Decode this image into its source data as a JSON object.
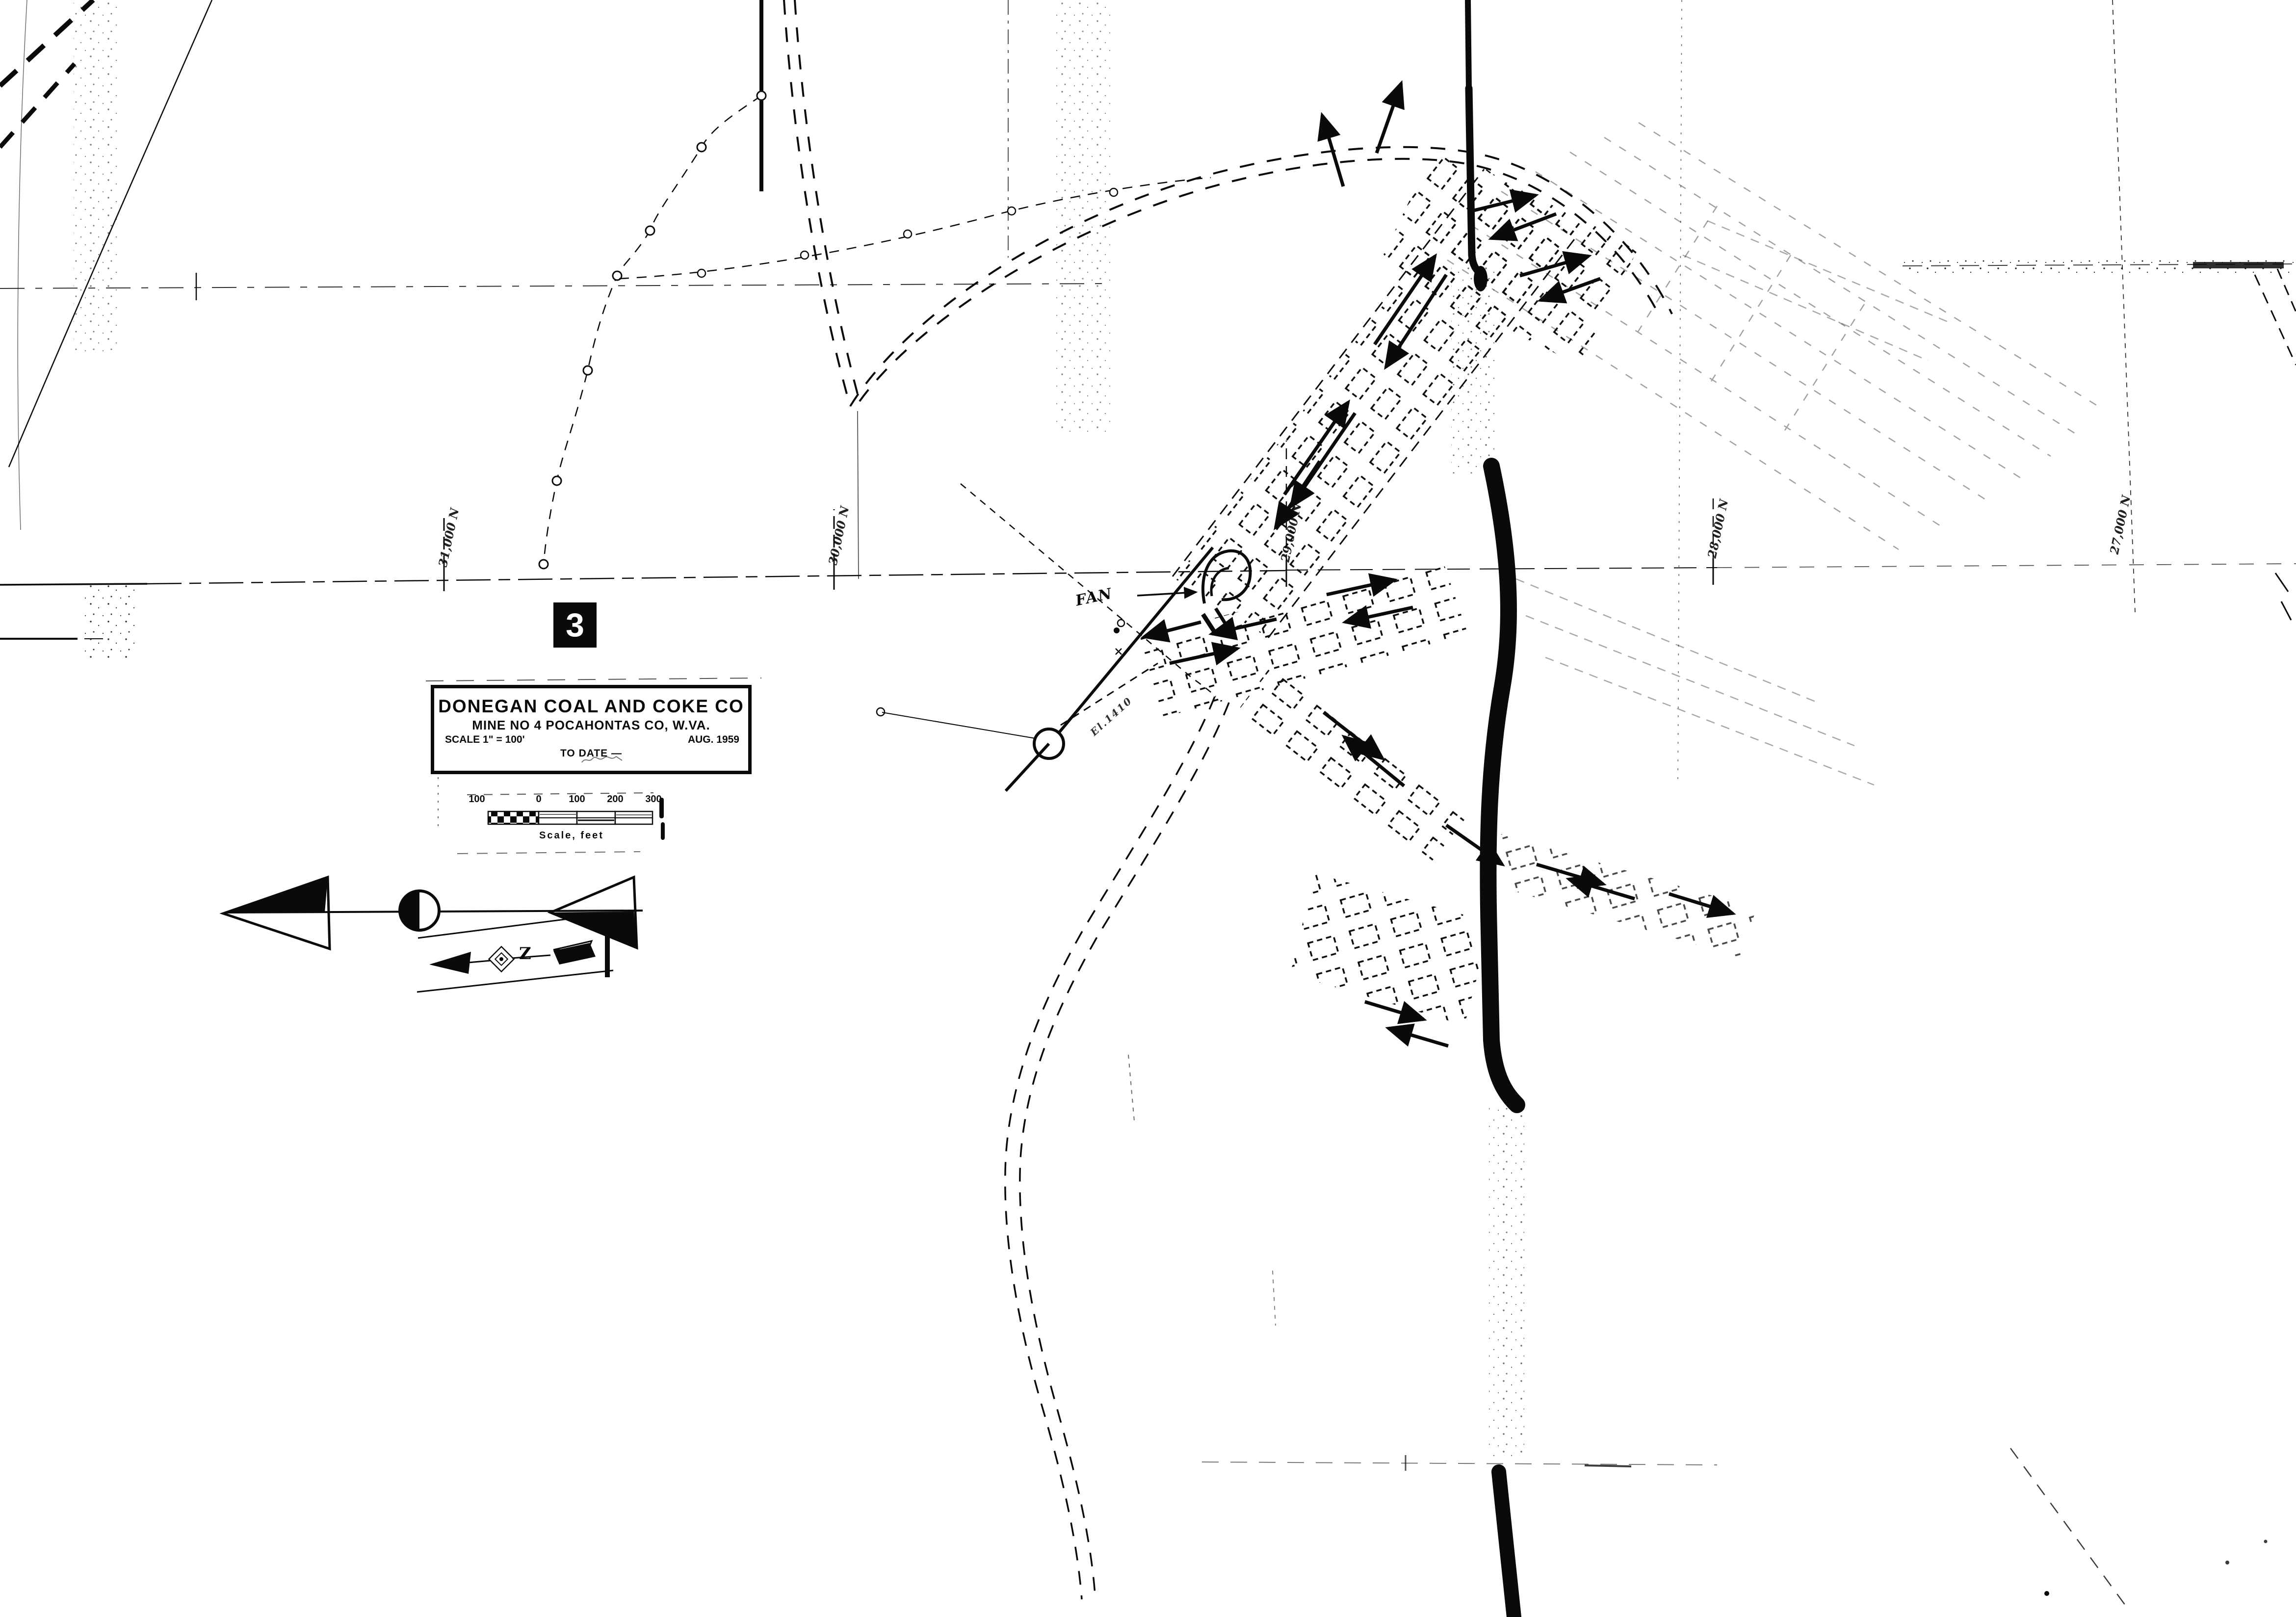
{
  "page": {
    "background": "#ffffff",
    "ink": "#0a0a0a"
  },
  "badge": {
    "number": "3"
  },
  "title_block": {
    "company": "DONEGAN COAL AND COKE CO",
    "mine_line": "MINE NO 4   POCAHONTAS CO,  W.VA.",
    "scale_label": "SCALE  1\" = 100'",
    "date_label": "AUG.   1959",
    "to_date_label": "TO DATE —"
  },
  "scale_bar": {
    "tick_labels": [
      "100",
      "0",
      "100",
      "200",
      "300"
    ],
    "caption": "Scale, feet"
  },
  "grid": {
    "labels": [
      {
        "text": "31,000 N"
      },
      {
        "text": "30,000 N"
      },
      {
        "text": "29,000 N"
      },
      {
        "text": "28,000 N"
      },
      {
        "text": "27,000 N"
      }
    ]
  },
  "annotations": {
    "fan_label": "FAN",
    "elevation_label": "El.1410",
    "magnetic_letter": "Z"
  }
}
